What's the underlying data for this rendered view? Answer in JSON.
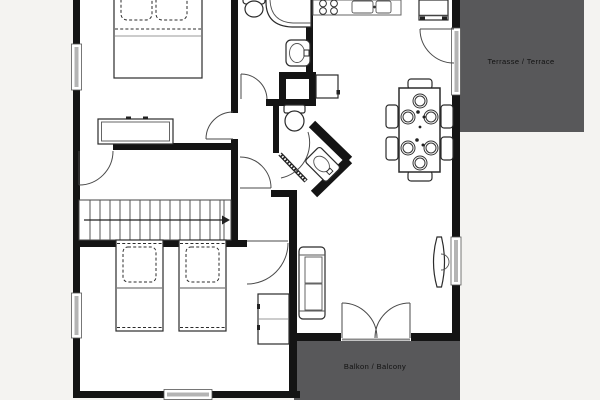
{
  "page": {
    "type": "apartment-floor-plan"
  },
  "labels": {
    "terrace": "Terrasse / Terrace",
    "balcony": "Balkon / Balcony"
  },
  "colors": {
    "background": "#f4f3f1",
    "floor": "#ffffff",
    "wall": "#141414",
    "outdoor_area": "#58585a",
    "window_glass": "#b4b4b4",
    "label_text": "#111111"
  },
  "furniture": [
    "double-bed",
    "dresser",
    "staircase",
    "single-bed",
    "single-bed",
    "wardrobe",
    "sofa",
    "tv",
    "dining-table",
    "dining-chairs-6",
    "place-settings-6",
    "stove-4-burners",
    "kitchen-sink-double",
    "fridge",
    "corner-bathtub",
    "toilet",
    "wash-basin",
    "toilet",
    "corner-wash-basin",
    "appliance"
  ]
}
